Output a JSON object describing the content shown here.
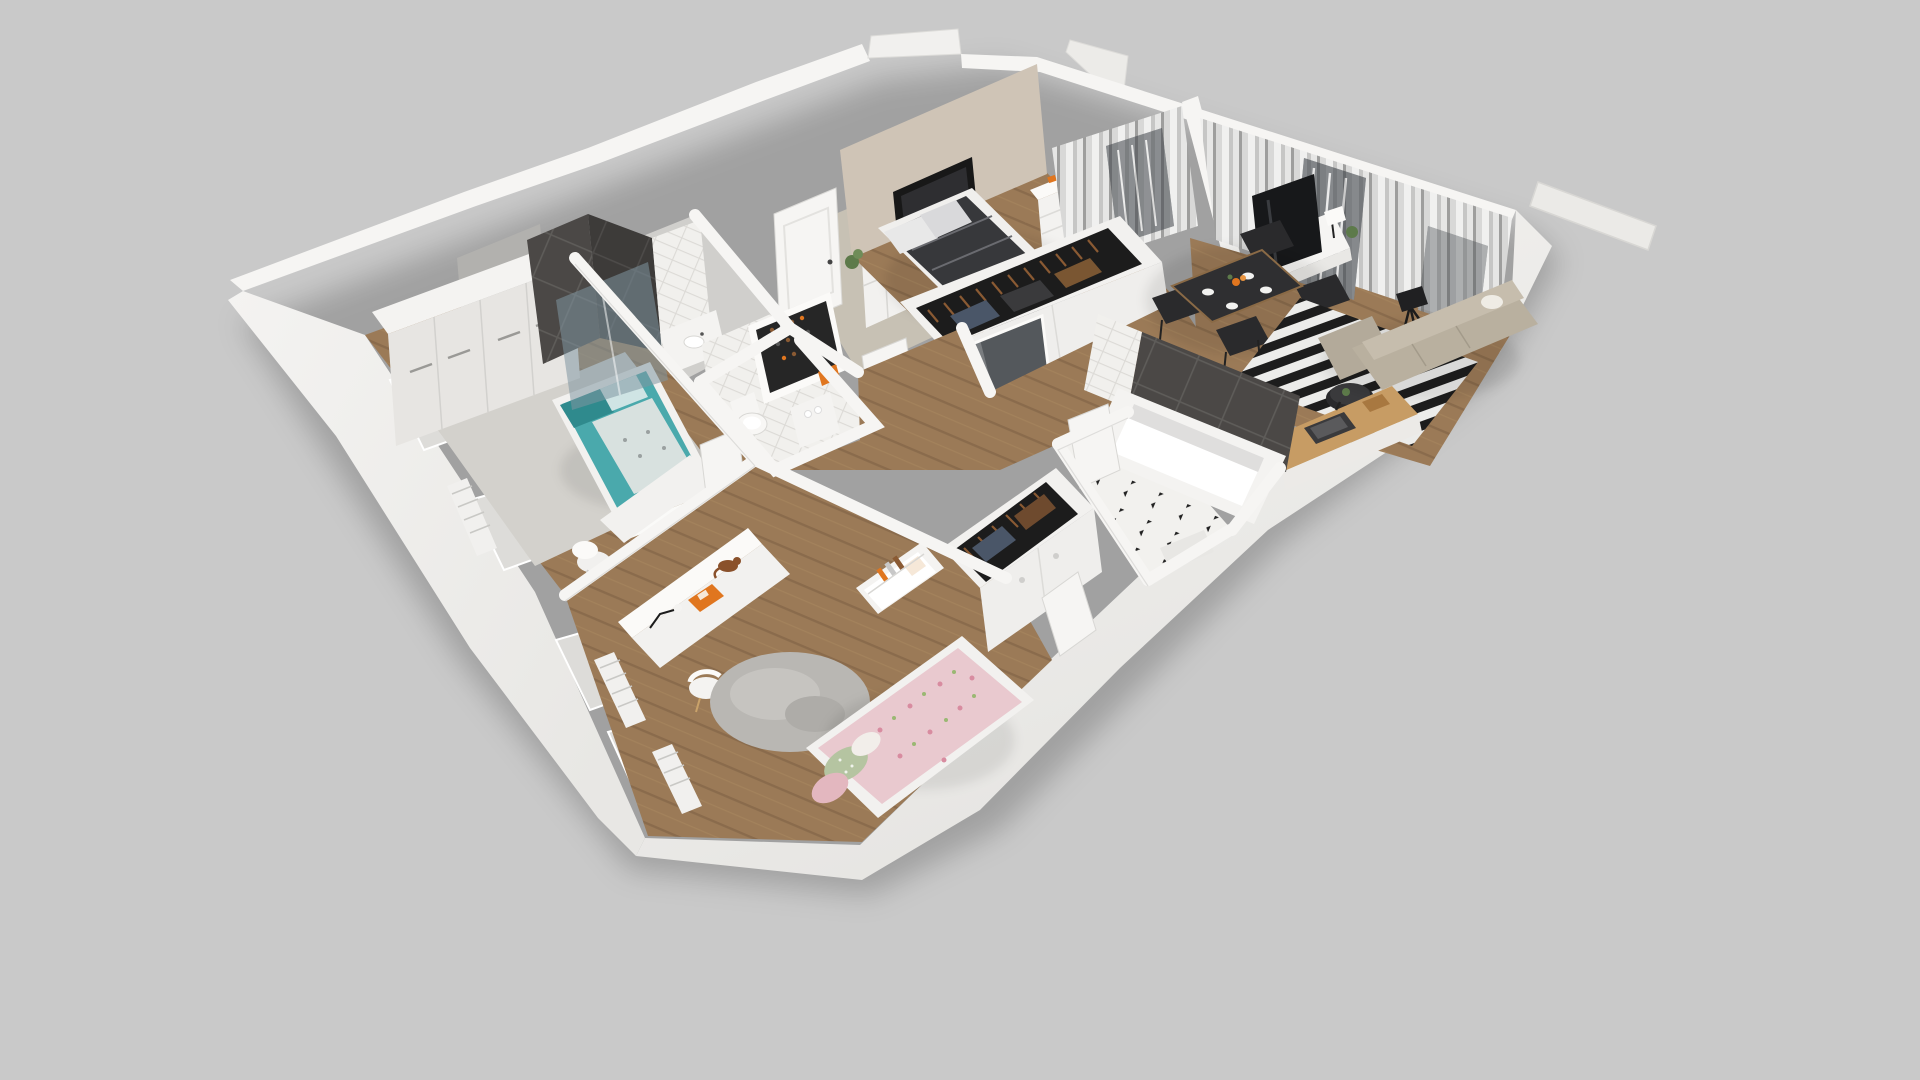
{
  "scene": {
    "kind": "3d-apartment-floor-plan-render",
    "view": "isometric-dollhouse-top",
    "background": "#c9c9c9"
  },
  "palette": {
    "bg": "#c9c9c9",
    "wall_top": "#f6f5f3",
    "wall_face": "#efeeeb",
    "wall_outer": "#f2f1ee",
    "wall_shade": "#d9d8d5",
    "wall_gray_face": "#b2b1ae",
    "beige_wall": "#cfc4b6",
    "floor_entry": "#c7c1b4",
    "floor_gray": "#d0cfcc",
    "rug_gray": "#d3d1cc",
    "rug_round": "#b9b7b3",
    "wood": "#9b7a57",
    "wood_line": "#86684a",
    "counter_wood": "#c79c64",
    "dark_tile": "#4b4846",
    "glass": "#7f96a0",
    "white": "#f4f3f1",
    "duvet_dark": "#37383b",
    "teal": "#4aa9ac",
    "teal_dark": "#2f8a8d",
    "pink": "#e9c9cf",
    "green_pillow": "#b5c4a1",
    "sofa": "#b9b09f",
    "sofa_back": "#c6bdad",
    "black_furniture": "#2a2a2c",
    "table_top": "#2f2f31",
    "rug_stripe_dark": "#1d1d1d",
    "rug_stripe_light": "#ececea",
    "orange": "#e0761f",
    "plant": "#5d7a4a",
    "cat": "#8a512b",
    "tv_dark": "#17181a",
    "niche_dark": "#181818",
    "balcony_dark": "#3f444a",
    "clothes_dark": "#1c1c1c",
    "hanger_brown": "#8a5a33",
    "checker_black": "#222222"
  },
  "rooms": [
    {
      "id": "bedroom-left",
      "name": "Bedroom (teal)",
      "furniture": [
        "wardrobe-4-door",
        "single-bed-teal",
        "gray-rug",
        "desk",
        "shell-chair",
        "radiator"
      ]
    },
    {
      "id": "shower-room",
      "name": "Shower room",
      "furniture": [
        "dark-tile-shower",
        "glass-screen",
        "vanity"
      ]
    },
    {
      "id": "wc",
      "name": "WC",
      "furniture": [
        "toilet",
        "paper-shelf",
        "door-ajar"
      ]
    },
    {
      "id": "entry",
      "name": "Entry hall",
      "furniture": [
        "front-door",
        "grid-cabinet",
        "shoe-rack",
        "door-ajar"
      ]
    },
    {
      "id": "master-bedroom",
      "name": "Master bedroom",
      "furniture": [
        "double-bed-dark",
        "dresser",
        "tv-niche",
        "curtains",
        "open-wardrobe-clothes",
        "glass-cabinet",
        "plant"
      ]
    },
    {
      "id": "living-room",
      "name": "Living room",
      "furniture": [
        "tv-stand",
        "tv",
        "table-lamp",
        "dining-table",
        "four-black-chairs",
        "striped-rug",
        "coffee-table",
        "tripod-lamp",
        "corner-sofa",
        "curtains",
        "balcony-door"
      ]
    },
    {
      "id": "kitchen",
      "name": "Kitchen nook",
      "furniture": [
        "wood-counter",
        "sink",
        "cutting-board"
      ]
    },
    {
      "id": "bathroom",
      "name": "Bathroom",
      "furniture": [
        "bathtub",
        "dark-tile-wall",
        "checker-floor",
        "bath-mat",
        "door-ajar"
      ]
    },
    {
      "id": "bedroom-bottom",
      "name": "Bedroom (pink)",
      "furniture": [
        "long-desk",
        "desk-lamp",
        "orange-book",
        "cat",
        "round-chair",
        "round-fluffy-rug",
        "bed-pink-floral",
        "bookshelf",
        "wardrobe-clothes",
        "radiator"
      ]
    }
  ]
}
